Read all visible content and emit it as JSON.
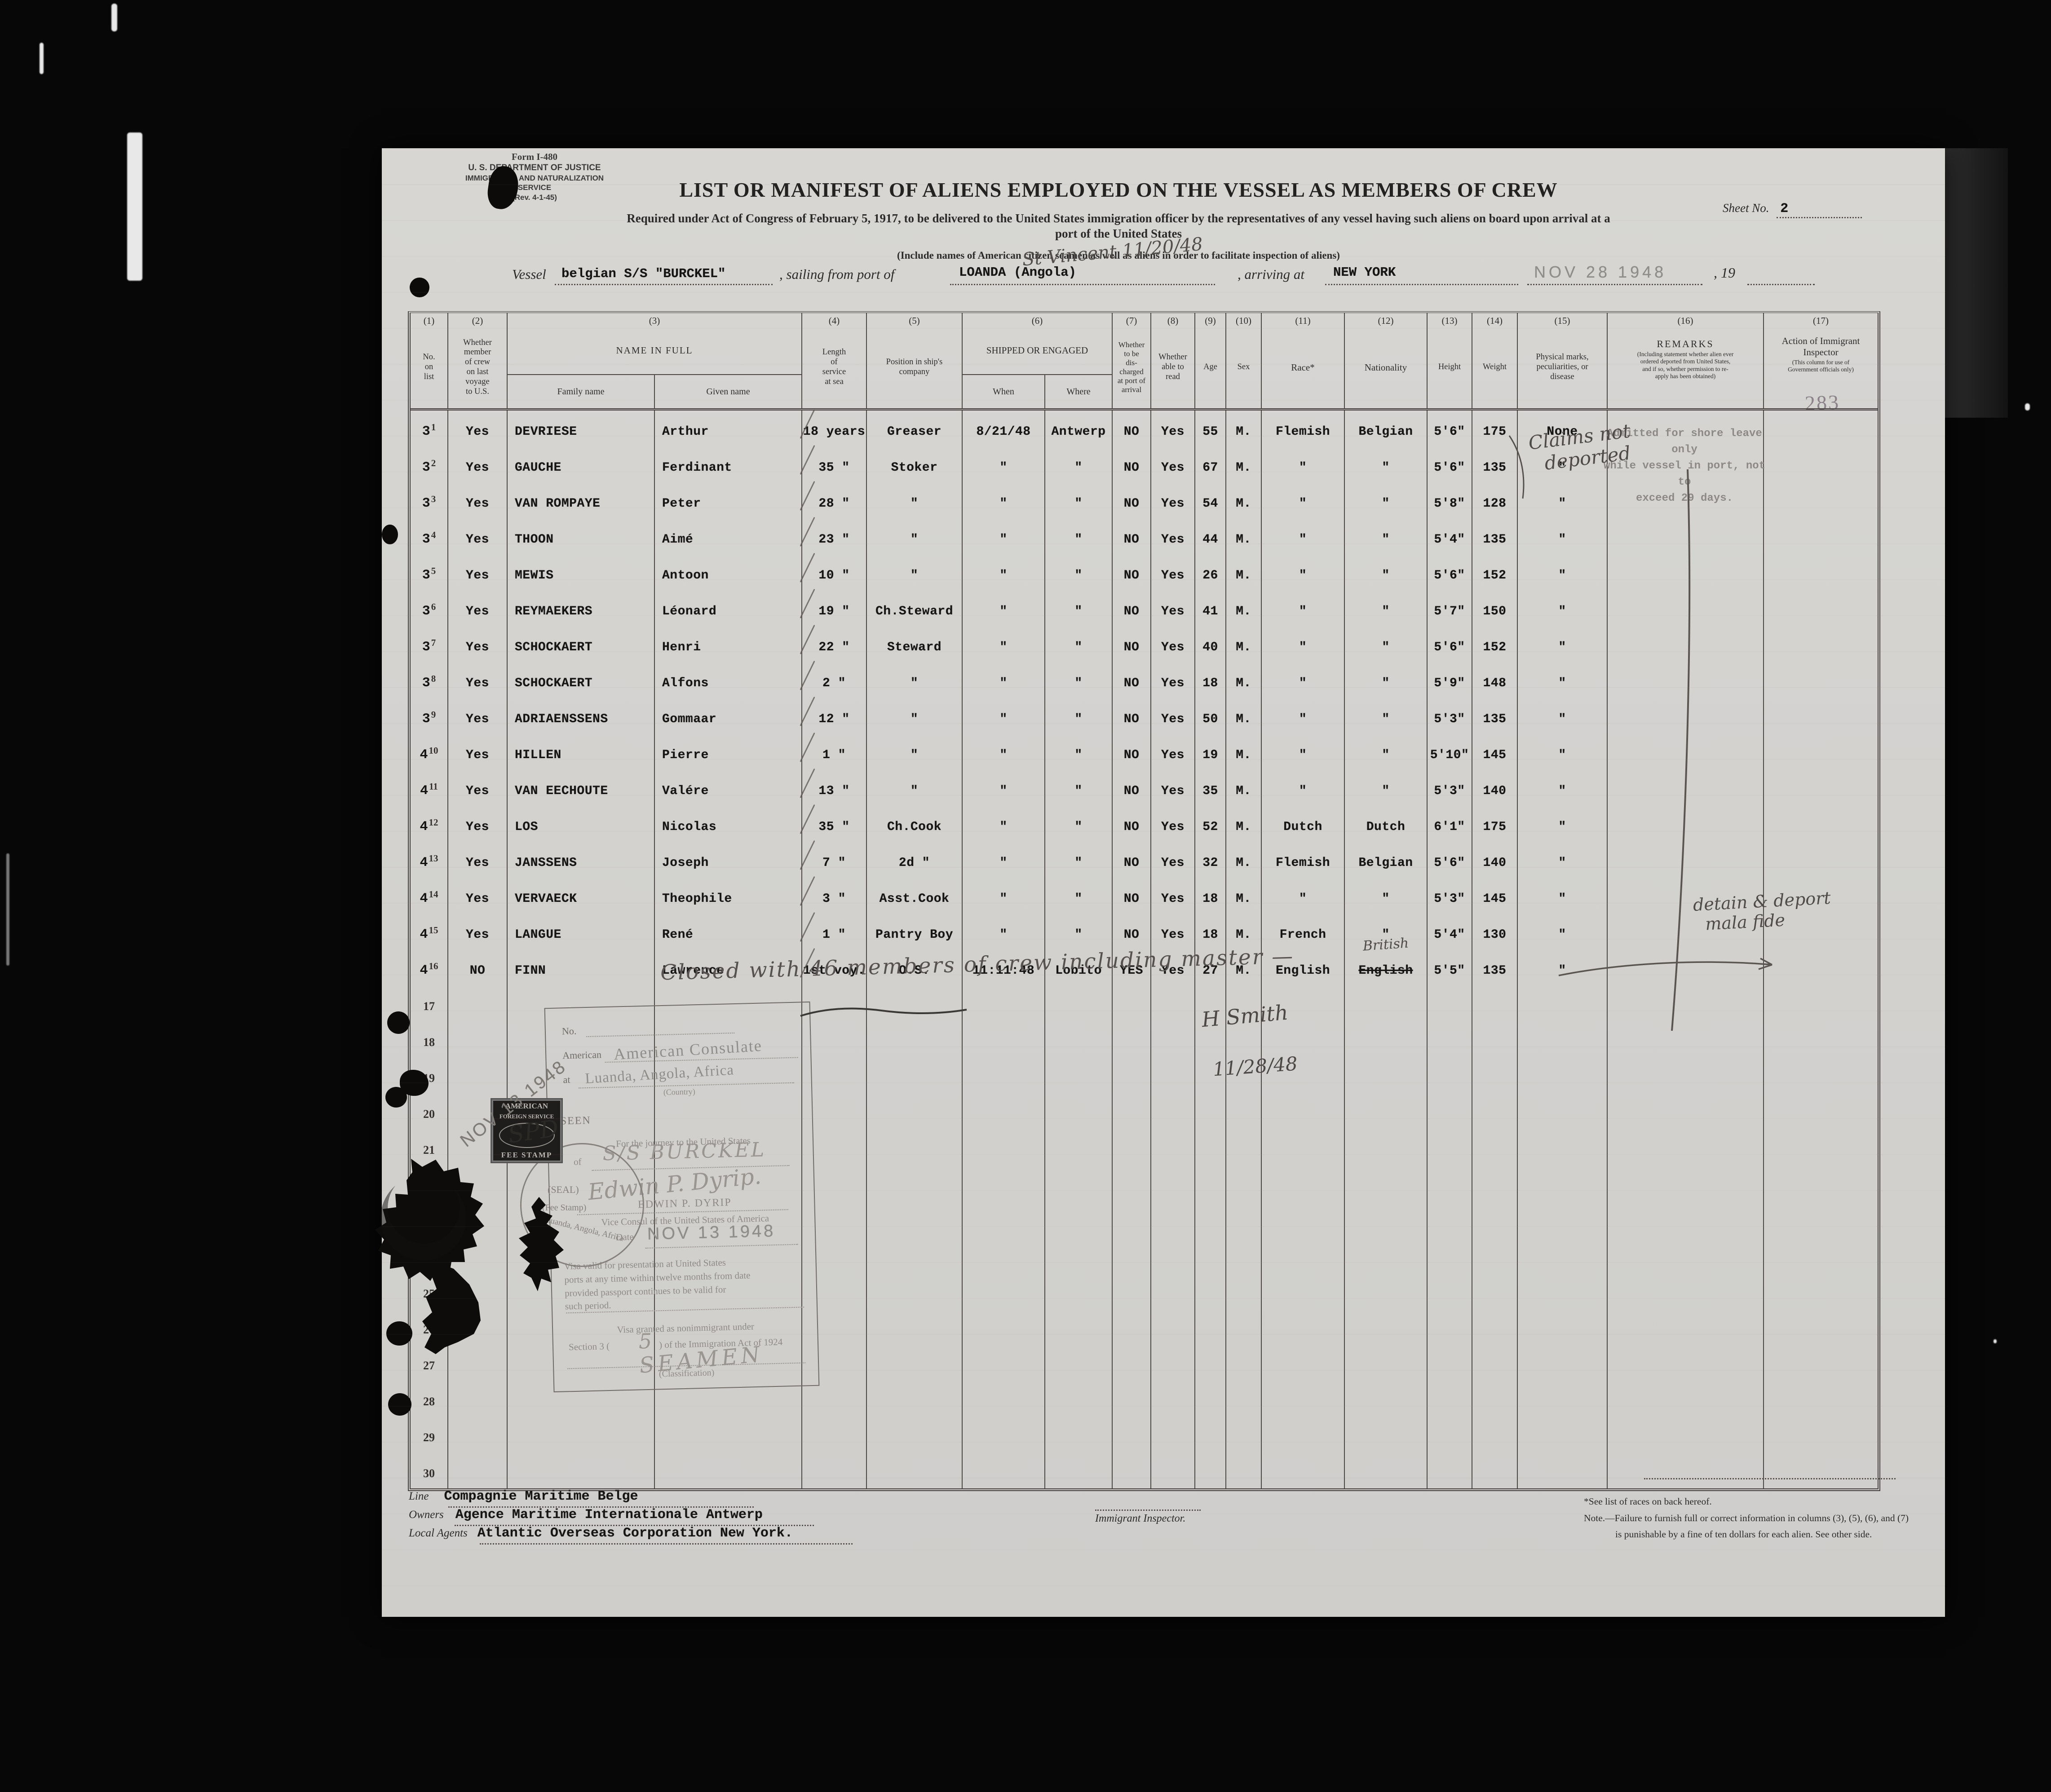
{
  "form": {
    "form_no": "Form I-480",
    "department": "U. S. DEPARTMENT OF JUSTICE",
    "service": "IMMIGRATION AND NATURALIZATION SERVICE",
    "revision": "(Rev. 4-1-45)",
    "sheet_label": "Sheet No.",
    "sheet_no": "2",
    "page_stamp": "283",
    "title": "LIST OR MANIFEST OF ALIENS EMPLOYED ON THE VESSEL AS MEMBERS OF CREW",
    "subtitle_line1": "Required under Act of Congress of February 5, 1917, to be delivered to the United States immigration officer by the representatives of any vessel having such aliens on board upon arrival at a",
    "subtitle_line2": "port of the United States",
    "subtitle_line3": "(Include names of American citizen seamen as well as aliens in order to facilitate inspection of aliens)"
  },
  "vessel_line": {
    "vessel_label": "Vessel",
    "vessel_value": "belgian  S/S \"BURCKEL\"",
    "sailing_label": ", sailing from port of",
    "port_value": "LOANDA (Angola)",
    "port_note_handwritten": "St Vincent 11/20/48",
    "arriving_label": ", arriving at",
    "arrival_port": "NEW YORK",
    "arrival_date_stamp": "NOV 28 1948",
    "year_label": ", 19"
  },
  "table": {
    "headers": [
      {
        "num": "(1)",
        "label": "No.\non\nlist"
      },
      {
        "num": "(2)",
        "label": "Whether\nmember\nof crew\non last\nvoyage\nto U.S."
      },
      {
        "num": "(3)",
        "label": "NAME IN FULL",
        "sub": [
          "Family name",
          "Given name"
        ]
      },
      {
        "num": "(4)",
        "label": "Length\nof\nservice\nat sea"
      },
      {
        "num": "(5)",
        "label": "Position in ship's\ncompany"
      },
      {
        "num": "(6)",
        "label": "SHIPPED OR ENGAGED",
        "sub": [
          "When",
          "Where"
        ]
      },
      {
        "num": "(7)",
        "label": "Whether\nto be\ndis-\ncharged\nat port of\narrival"
      },
      {
        "num": "(8)",
        "label": "Whether\nable to\nread"
      },
      {
        "num": "(9)",
        "label": "Age"
      },
      {
        "num": "(10)",
        "label": "Sex"
      },
      {
        "num": "(11)",
        "label": "Race*"
      },
      {
        "num": "(12)",
        "label": "Nationality"
      },
      {
        "num": "(13)",
        "label": "Height"
      },
      {
        "num": "(14)",
        "label": "Weight"
      },
      {
        "num": "(15)",
        "label": "Physical marks,\npeculiarities, or\ndisease"
      },
      {
        "num": "(16)",
        "label": "REMARKS",
        "note": "(Including statement whether alien ever\nordered deported from United States,\nand if so, whether permission to re-\napply has been obtained)"
      },
      {
        "num": "(17)",
        "label": "Action of Immigrant\nInspector",
        "note": "(This column for use of\nGovernment officials only)"
      }
    ],
    "rows": [
      {
        "no_typed": "3",
        "no_printed": "1",
        "member": "Yes",
        "family": "DEVRIESE",
        "given": "Arthur",
        "service": "18 years",
        "position": "Greaser",
        "when": "8/21/48",
        "where": "Antwerp",
        "discharged": "NO",
        "read": "Yes",
        "age": "55",
        "sex": "M.",
        "race": "Flemish",
        "nationality": "Belgian",
        "height": "5'6\"",
        "weight": "175",
        "marks": "None"
      },
      {
        "no_typed": "3",
        "no_printed": "2",
        "member": "Yes",
        "family": "GAUCHE",
        "given": "Ferdinant",
        "service": "35 \"",
        "position": "Stoker",
        "when": "\"",
        "where": "\"",
        "discharged": "NO",
        "read": "Yes",
        "age": "67",
        "sex": "M.",
        "race": "\"",
        "nationality": "\"",
        "height": "5'6\"",
        "weight": "135",
        "marks": "\""
      },
      {
        "no_typed": "3",
        "no_printed": "3",
        "member": "Yes",
        "family": "VAN ROMPAYE",
        "given": "Peter",
        "service": "28 \"",
        "position": "\"",
        "when": "\"",
        "where": "\"",
        "discharged": "NO",
        "read": "Yes",
        "age": "54",
        "sex": "M.",
        "race": "\"",
        "nationality": "\"",
        "height": "5'8\"",
        "weight": "128",
        "marks": "\""
      },
      {
        "no_typed": "3",
        "no_printed": "4",
        "member": "Yes",
        "family": "THOON",
        "given": "Aimé",
        "service": "23 \"",
        "position": "\"",
        "when": "\"",
        "where": "\"",
        "discharged": "NO",
        "read": "Yes",
        "age": "44",
        "sex": "M.",
        "race": "\"",
        "nationality": "\"",
        "height": "5'4\"",
        "weight": "135",
        "marks": "\""
      },
      {
        "no_typed": "3",
        "no_printed": "5",
        "member": "Yes",
        "family": "MEWIS",
        "given": "Antoon",
        "service": "10 \"",
        "position": "\"",
        "when": "\"",
        "where": "\"",
        "discharged": "NO",
        "read": "Yes",
        "age": "26",
        "sex": "M.",
        "race": "\"",
        "nationality": "\"",
        "height": "5'6\"",
        "weight": "152",
        "marks": "\""
      },
      {
        "no_typed": "3",
        "no_printed": "6",
        "member": "Yes",
        "family": "REYMAEKERS",
        "given": "Léonard",
        "service": "19 \"",
        "position": "Ch.Steward",
        "when": "\"",
        "where": "\"",
        "discharged": "NO",
        "read": "Yes",
        "age": "41",
        "sex": "M.",
        "race": "\"",
        "nationality": "\"",
        "height": "5'7\"",
        "weight": "150",
        "marks": "\""
      },
      {
        "no_typed": "3",
        "no_printed": "7",
        "member": "Yes",
        "family": "SCHOCKAERT",
        "given": "Henri",
        "service": "22 \"",
        "position": "Steward",
        "when": "\"",
        "where": "\"",
        "discharged": "NO",
        "read": "Yes",
        "age": "40",
        "sex": "M.",
        "race": "\"",
        "nationality": "\"",
        "height": "5'6\"",
        "weight": "152",
        "marks": "\""
      },
      {
        "no_typed": "3",
        "no_printed": "8",
        "member": "Yes",
        "family": "SCHOCKAERT",
        "given": "Alfons",
        "service": "2 \"",
        "position": "\"",
        "when": "\"",
        "where": "\"",
        "discharged": "NO",
        "read": "Yes",
        "age": "18",
        "sex": "M.",
        "race": "\"",
        "nationality": "\"",
        "height": "5'9\"",
        "weight": "148",
        "marks": "\""
      },
      {
        "no_typed": "3",
        "no_printed": "9",
        "member": "Yes",
        "family": "ADRIAENSSENS",
        "given": "Gommaar",
        "service": "12 \"",
        "position": "\"",
        "when": "\"",
        "where": "\"",
        "discharged": "NO",
        "read": "Yes",
        "age": "50",
        "sex": "M.",
        "race": "\"",
        "nationality": "\"",
        "height": "5'3\"",
        "weight": "135",
        "marks": "\""
      },
      {
        "no_typed": "4",
        "no_printed": "10",
        "member": "Yes",
        "family": "HILLEN",
        "given": "Pierre",
        "service": "1 \"",
        "position": "\"",
        "when": "\"",
        "where": "\"",
        "discharged": "NO",
        "read": "Yes",
        "age": "19",
        "sex": "M.",
        "race": "\"",
        "nationality": "\"",
        "height": "5'10\"",
        "weight": "145",
        "marks": "\""
      },
      {
        "no_typed": "4",
        "no_printed": "11",
        "member": "Yes",
        "family": "VAN EECHOUTE",
        "given": "Valére",
        "service": "13 \"",
        "position": "\"",
        "when": "\"",
        "where": "\"",
        "discharged": "NO",
        "read": "Yes",
        "age": "35",
        "sex": "M.",
        "race": "\"",
        "nationality": "\"",
        "height": "5'3\"",
        "weight": "140",
        "marks": "\""
      },
      {
        "no_typed": "4",
        "no_printed": "12",
        "member": "Yes",
        "family": "LOS",
        "given": "Nicolas",
        "service": "35 \"",
        "position": "Ch.Cook",
        "when": "\"",
        "where": "\"",
        "discharged": "NO",
        "read": "Yes",
        "age": "52",
        "sex": "M.",
        "race": "Dutch",
        "nationality": "Dutch",
        "height": "6'1\"",
        "weight": "175",
        "marks": "\""
      },
      {
        "no_typed": "4",
        "no_printed": "13",
        "member": "Yes",
        "family": "JANSSENS",
        "given": "Joseph",
        "service": "7 \"",
        "position": "2d  \"",
        "when": "\"",
        "where": "\"",
        "discharged": "NO",
        "read": "Yes",
        "age": "32",
        "sex": "M.",
        "race": "Flemish",
        "nationality": "Belgian",
        "height": "5'6\"",
        "weight": "140",
        "marks": "\""
      },
      {
        "no_typed": "4",
        "no_printed": "14",
        "member": "Yes",
        "family": "VERVAECK",
        "given": "Theophile",
        "service": "3 \"",
        "position": "Asst.Cook",
        "when": "\"",
        "where": "\"",
        "discharged": "NO",
        "read": "Yes",
        "age": "18",
        "sex": "M.",
        "race": "\"",
        "nationality": "\"",
        "height": "5'3\"",
        "weight": "145",
        "marks": "\""
      },
      {
        "no_typed": "4",
        "no_printed": "15",
        "member": "Yes",
        "family": "LANGUE",
        "given": "René",
        "service": "1 \"",
        "position": "Pantry Boy",
        "when": "\"",
        "where": "\"",
        "discharged": "NO",
        "read": "Yes",
        "age": "18",
        "sex": "M.",
        "race": "French",
        "nationality": "\"",
        "height": "5'4\"",
        "weight": "130",
        "marks": "\""
      },
      {
        "no_typed": "4",
        "no_printed": "16",
        "member": "NO",
        "family": "FINN",
        "given": "Lawrence",
        "service": "1st voy.",
        "position": "O.S.",
        "when": "11:11:48",
        "where": "Lobito",
        "discharged": "YES",
        "read": "Yes",
        "age": "27",
        "sex": "M.",
        "race": "English",
        "nationality": "English",
        "nationality_struck": true,
        "nationality_correction": "British",
        "height": "5'5\"",
        "weight": "135",
        "marks": "\""
      }
    ],
    "empty_rows": [
      "17",
      "18",
      "19",
      "20",
      "21",
      "22",
      "23",
      "24",
      "25",
      "26",
      "27",
      "28",
      "29",
      "30"
    ]
  },
  "remarks_column": {
    "stamp_line1": "Admitted for shore leave only",
    "stamp_line2": "while vessel in port, not to",
    "stamp_line3": "exceed 29 days.",
    "handwritten_overlay_line1": "Claims not",
    "handwritten_overlay_line2": "deported",
    "row16_note_line1": "detain & deport",
    "row16_note_line2": "mala fide"
  },
  "closing": {
    "statement": "Closed with  46  members of crew including master —",
    "signature": "H Smith",
    "date": "11/28/48"
  },
  "visa_box": {
    "no_label": "No.",
    "american_label": "American",
    "consulate_stamp": "American Consulate",
    "at_label": "at",
    "location_stamp": "Luanda,  Angola,  Africa",
    "country_label": "(Country)",
    "seen_label": "SEEN",
    "journey_line": "For the journey to the United States",
    "of_label": "of",
    "vessel_handwritten": "S/S BURCKEL",
    "signature_handwritten": "Edwin P. Dyrip.",
    "officer_name_print": "EDWIN P. DYRIP",
    "officer_title": "Vice Consul of the United States of America",
    "date_label": "Date",
    "date_stamp": "NOV 13 1948",
    "validity_text": "Visa valid for presentation at United States\nports at any time within twelve months from date\nprovided passport continues to be valid for\nsuch period.",
    "granted_line": "Visa granted as nonimmigrant under",
    "section_left": "Section 3 (",
    "section_no_handwritten": "5",
    "section_right": ") of the Immigration Act of 1924",
    "classification_handwritten": "SEAMEN",
    "classification_label": "(Classification)",
    "seal_word": "(SEAL)",
    "feestamp_word": "(Fee Stamp)",
    "seal_ring_bottom": "Luanda, Angola, Africa"
  },
  "stamps": {
    "diagonal_date": "NOV 13 1948",
    "fee_stamp_line1": "AMERICAN",
    "fee_stamp_line2": "FOREIGN SERVICE",
    "fee_stamp_line3": "FEE STAMP",
    "fee_stamp_scrawl": "SPD"
  },
  "footer": {
    "line_label": "Line",
    "line_value": "Compagnie  Maritime  Belge",
    "owners_label": "Owners",
    "owners_value": "Agence Maritime Internationale  Antwerp",
    "agents_label": "Local Agents",
    "agents_value": "Atlantic Overseas Corporation  New York.",
    "inspector_label": "Immigrant Inspector.",
    "races_note": "*See list of races on back hereof.",
    "note_line1": "Note.—Failure to furnish full or correct information in columns (3), (5), (6), and (7)",
    "note_line2": "is punishable by a fine of ten dollars for each alien.   See other side."
  }
}
